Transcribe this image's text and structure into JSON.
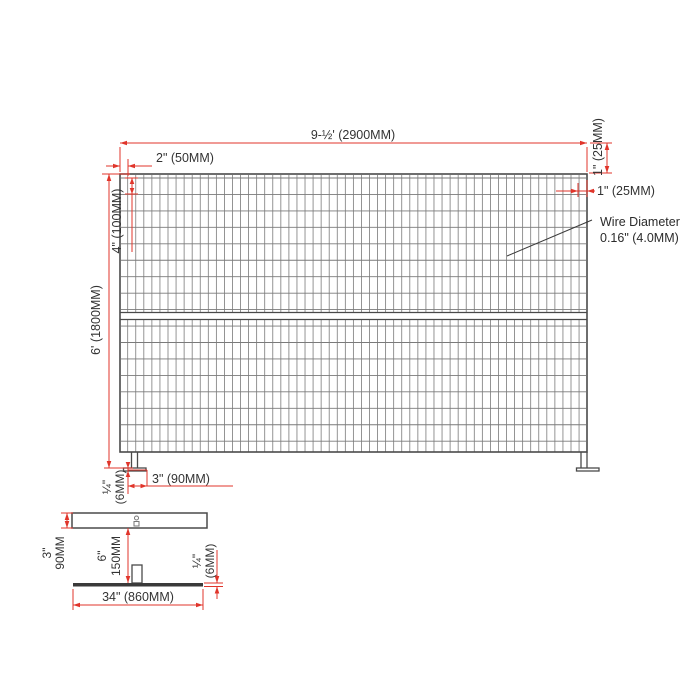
{
  "drawing": {
    "type_note_line1": "Wire Diameter",
    "type_note_line2": "0.16\" (4.0MM)"
  },
  "panel": {
    "overall_width_label": "9-½' (2900MM)",
    "wire_pitch_horizontal_label": "2\" (50MM)",
    "frame_tube_top_label": "1\" (25MM)",
    "frame_edge_gap_label": "1\" (25MM)",
    "wire_pitch_vertical_label": "4\" (100MM)",
    "overall_height_label": "6' (1800MM)",
    "foot_thickness_label_line1": "¼\"",
    "foot_thickness_label_line2": "(6MM)",
    "foot_width_label": "3\" (90MM)"
  },
  "base_detail": {
    "plate_height_label_line1": "3\"",
    "plate_height_label_line2": "90MM",
    "leg_height_label_line1": "6\"",
    "leg_height_label_line2": "150MM",
    "plate_thickness_label_line1": "¼\"",
    "plate_thickness_label_line2": "(6MM)",
    "plate_width_label": "34\" (860MM)"
  },
  "colors": {
    "dimension": "#e0352b",
    "frame": "#4a4a4a",
    "mesh": "#7a7a7a",
    "text": "#333333"
  }
}
